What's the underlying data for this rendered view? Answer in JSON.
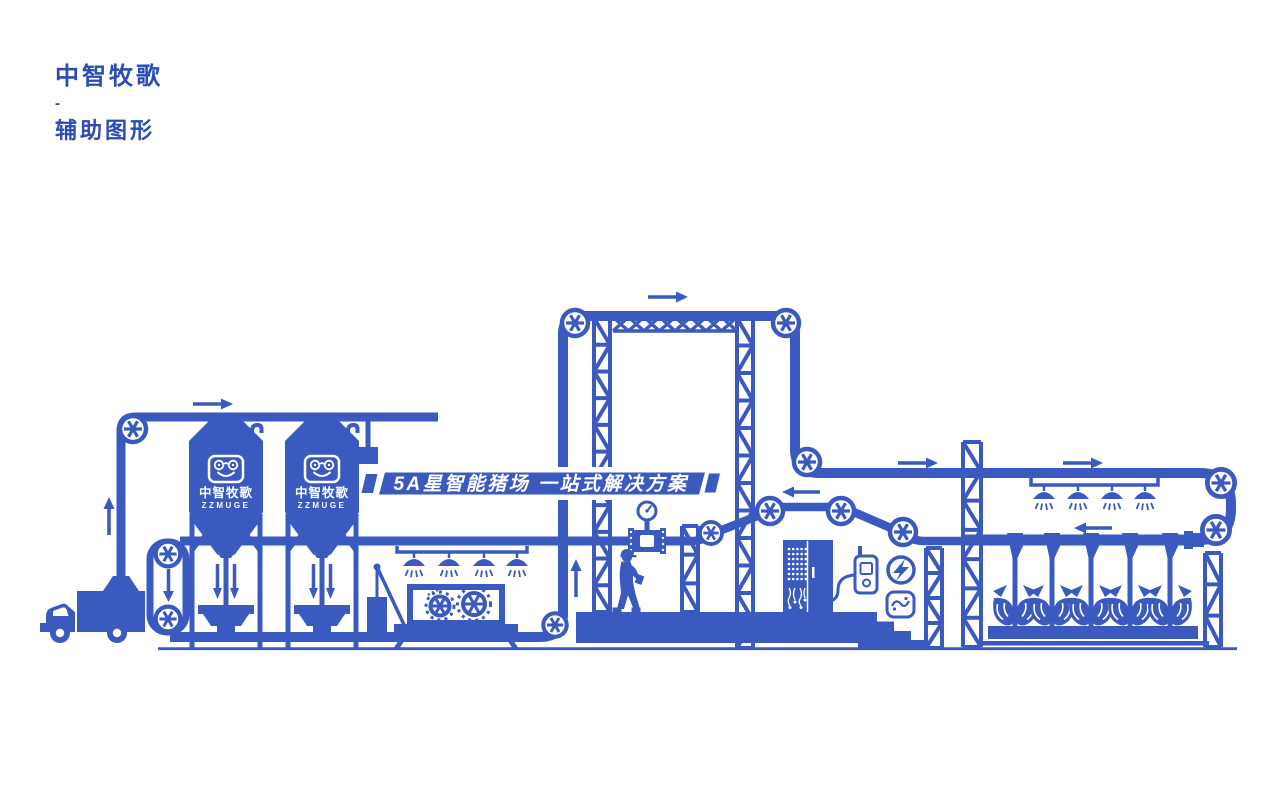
{
  "header": {
    "brand": "中智牧歌",
    "divider": "-",
    "subtitle": "辅助图形"
  },
  "banner": {
    "text": "5A星智能猪场  一站式解决方案"
  },
  "silos": [
    {
      "label": "中智牧歌",
      "sublabel": "ZZMUGE"
    },
    {
      "label": "中智牧歌",
      "sublabel": "ZZMUGE"
    }
  ],
  "colors": {
    "primary": "#3a5abf",
    "header_text": "#2b4bb5",
    "background": "#ffffff",
    "text_on_blue": "#ffffff"
  },
  "icons": {
    "pulley": "spoked-wheel",
    "arrow": "flow-direction-arrow",
    "sprinkler": "spray-nozzle",
    "pig": "pig-silhouette",
    "gear": "gear-wheel",
    "gauge": "pressure-gauge",
    "lightning": "lightning-bolt-circle",
    "badge": "sensor-badge",
    "truck": "box-truck",
    "worker": "worker-silhouette",
    "cabinet": "control-cabinet",
    "remote": "handheld-controller",
    "silo": "feed-silo",
    "tower": "lattice-tower"
  }
}
